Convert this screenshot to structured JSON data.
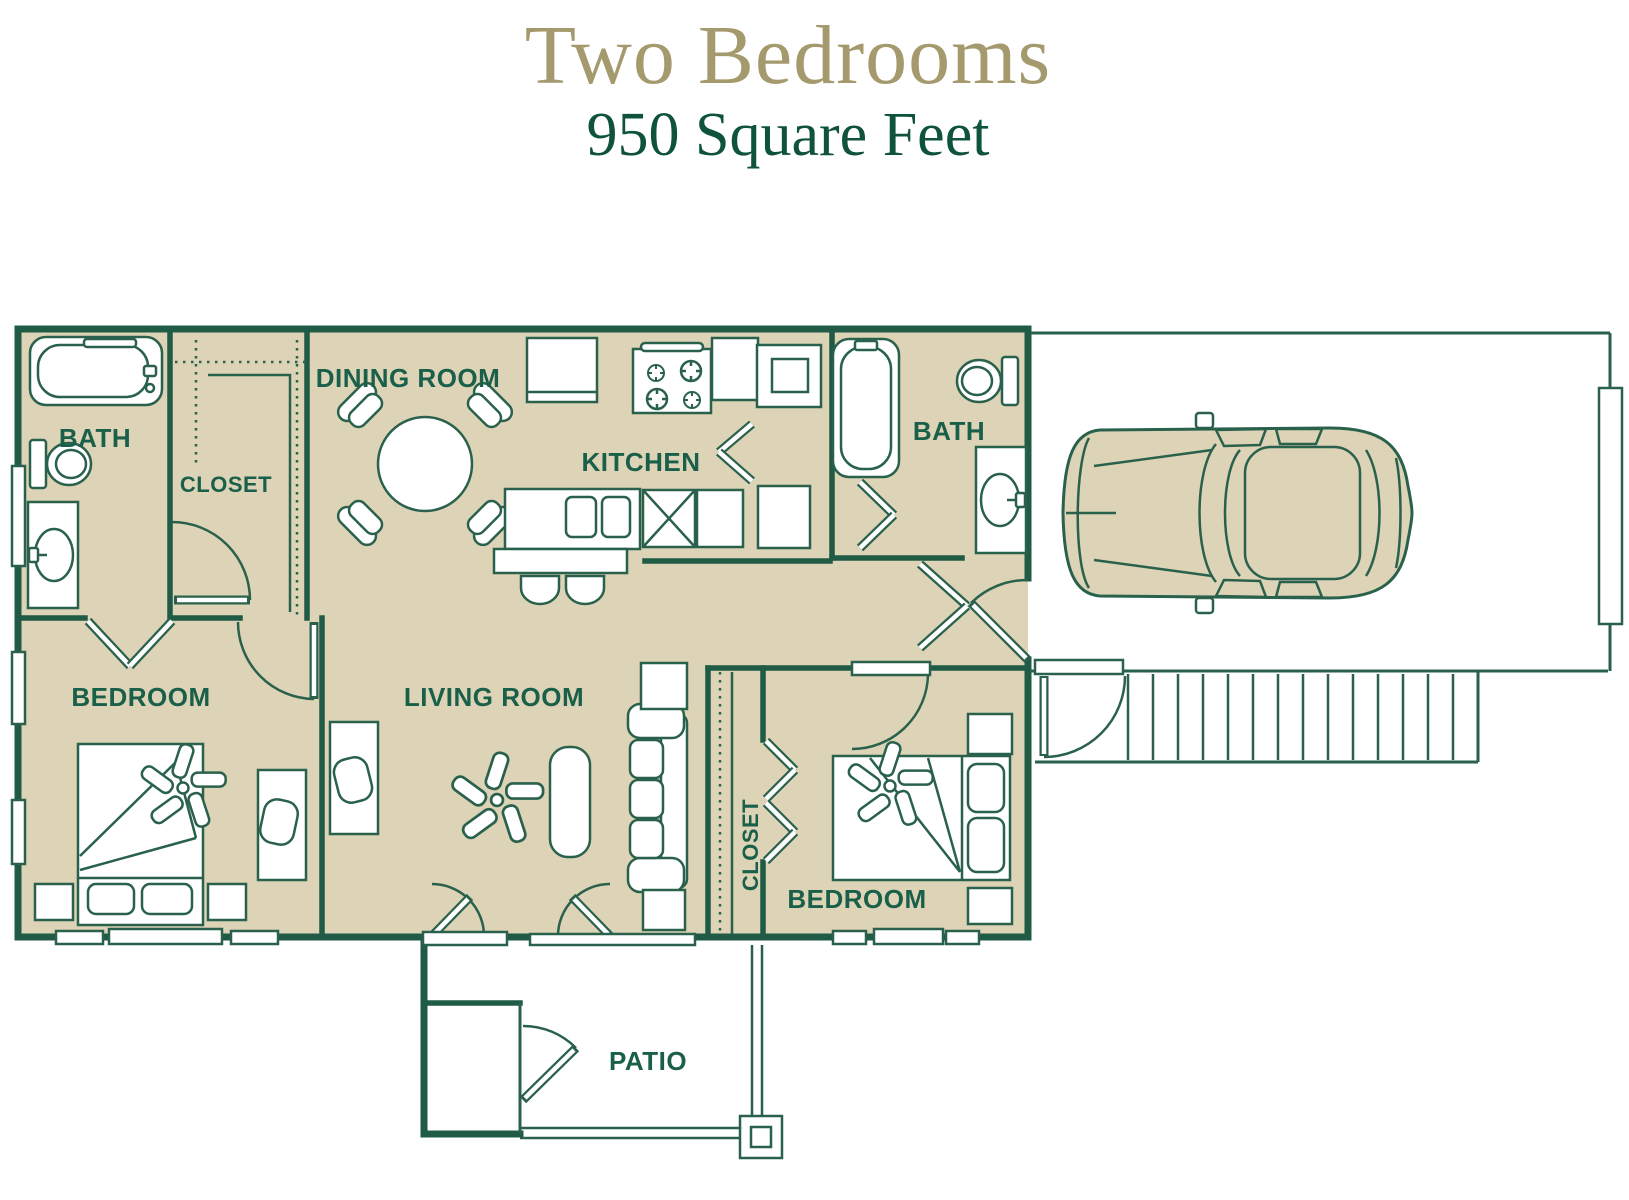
{
  "title": {
    "main": "Two Bedrooms",
    "subtitle": "950 Square Feet"
  },
  "rooms": {
    "bath1": "BATH",
    "closet1": "CLOSET",
    "dining": "DINING ROOM",
    "kitchen": "KITCHEN",
    "bath2": "BATH",
    "bedroom1": "BEDROOM",
    "living": "LIVING ROOM",
    "closet2": "CLOSET",
    "bedroom2": "BEDROOM",
    "patio": "PATIO"
  },
  "colors": {
    "title_tan": "#a59a6e",
    "subtitle_green": "#0f523e",
    "wall_green": "#205b46",
    "fixture_green": "#2a614c",
    "label_green": "#1a5f49",
    "floor_tan": "#ddd3b6",
    "background": "#ffffff"
  }
}
